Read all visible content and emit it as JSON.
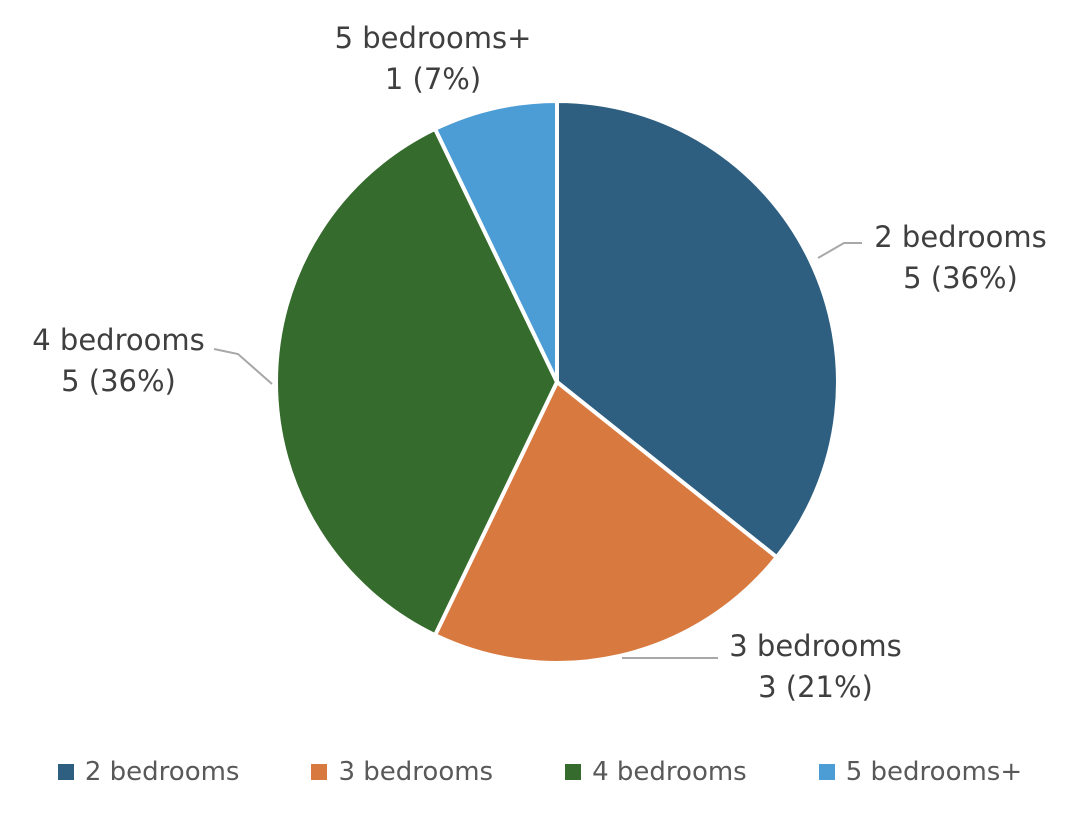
{
  "chart_data": {
    "type": "pie",
    "title": "",
    "categories": [
      "2 bedrooms",
      "3 bedrooms",
      "4 bedrooms",
      "5 bedrooms+"
    ],
    "values": [
      5,
      3,
      5,
      1
    ],
    "total": 14,
    "start_angle_deg": -90,
    "direction": "clockwise",
    "legend_position": "bottom",
    "slices": [
      {
        "label": "2 bedrooms",
        "value": 5,
        "pct": "36%",
        "display": "5 (36%)",
        "color": "#2e5f80"
      },
      {
        "label": "3 bedrooms",
        "value": 3,
        "pct": "21%",
        "display": "3 (21%)",
        "color": "#d87a40"
      },
      {
        "label": "4 bedrooms",
        "value": 5,
        "pct": "36%",
        "display": "5 (36%)",
        "color": "#356b2c"
      },
      {
        "label": "5 bedrooms+",
        "value": 1,
        "pct": "7%",
        "display": "1 (7%)",
        "color": "#4c9cd5"
      }
    ],
    "colors": {
      "label_text": "#3f3f3f",
      "legend_text": "#595959",
      "leader_line": "#a8a8a8",
      "slice_separator": "#ffffff",
      "background": "#ffffff"
    }
  }
}
